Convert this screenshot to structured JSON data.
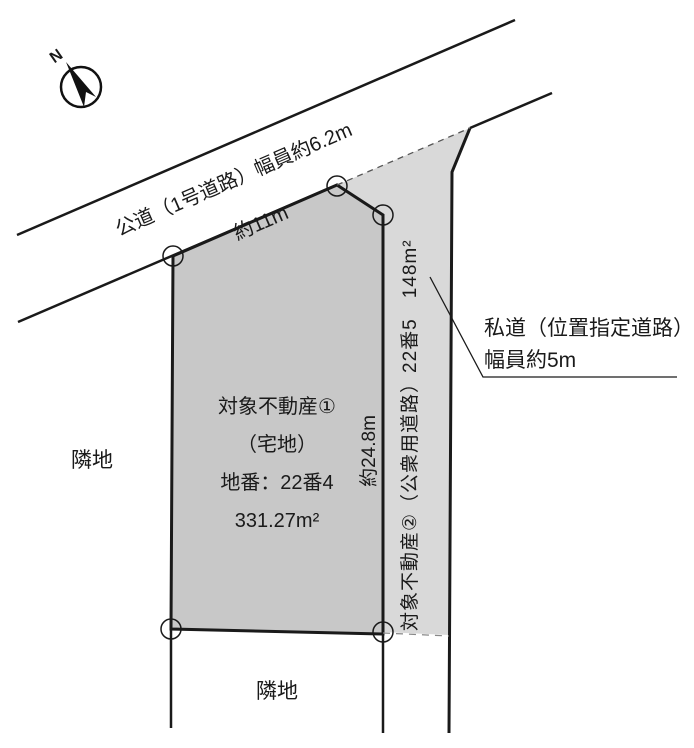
{
  "diagram": {
    "compass": {
      "north_label": "N"
    },
    "public_road": {
      "label": "公道（1号道路）幅員約6.2m"
    },
    "frontage": {
      "label": "約11m"
    },
    "depth": {
      "label": "約24.8m"
    },
    "plot1": {
      "title": "対象不動産①",
      "land_type": "（宅地）",
      "lot_number": "地番：22番4",
      "area": "331.27m²"
    },
    "plot2": {
      "label": "対象不動産②（公衆用道路）22番5　148m²"
    },
    "private_road_callout": {
      "line1": "私道（位置指定道路）",
      "line2": "幅員約5m"
    },
    "neighbor_left": {
      "label": "隣地"
    },
    "neighbor_bottom": {
      "label": "隣地"
    }
  },
  "colors": {
    "line": "#1a1a1a",
    "plot1_fill": "#c8c8c8",
    "plot2_fill": "#d9d9d9"
  }
}
